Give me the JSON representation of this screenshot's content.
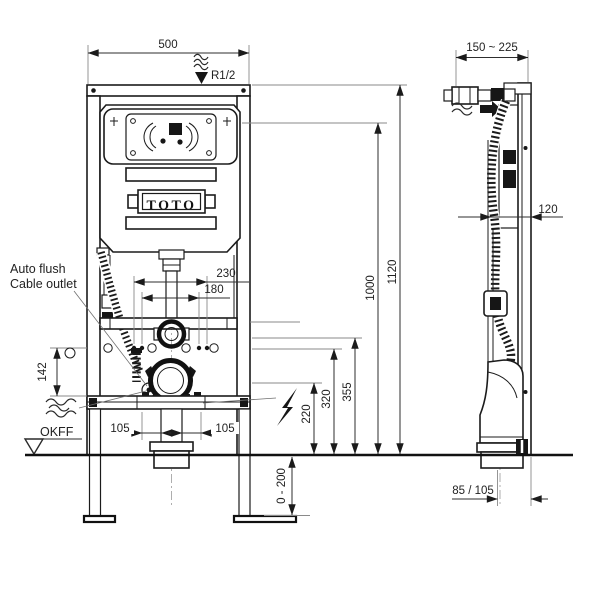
{
  "labels": {
    "brand": "TOTO",
    "auto_flush": "Auto flush",
    "cable_outlet": "Cable outlet",
    "floor_marker": "OKFF",
    "supply_thread": "R1/2"
  },
  "front_dims": {
    "overall_width": "500",
    "bolt_span_outer": "230",
    "bolt_span_inner": "180",
    "outlet_side_height": "142",
    "offset_left": "105",
    "offset_right": "105",
    "drain_center_height": "220",
    "height_320": "320",
    "height_355": "355",
    "cistern_top_height": "1000",
    "frame_height": "1120",
    "leg_adjust_range": "0 - 200"
  },
  "side_dims": {
    "install_depth_range": "150 ~ 225",
    "frame_depth": "120",
    "drain_wall_offset": "85 / 105"
  }
}
